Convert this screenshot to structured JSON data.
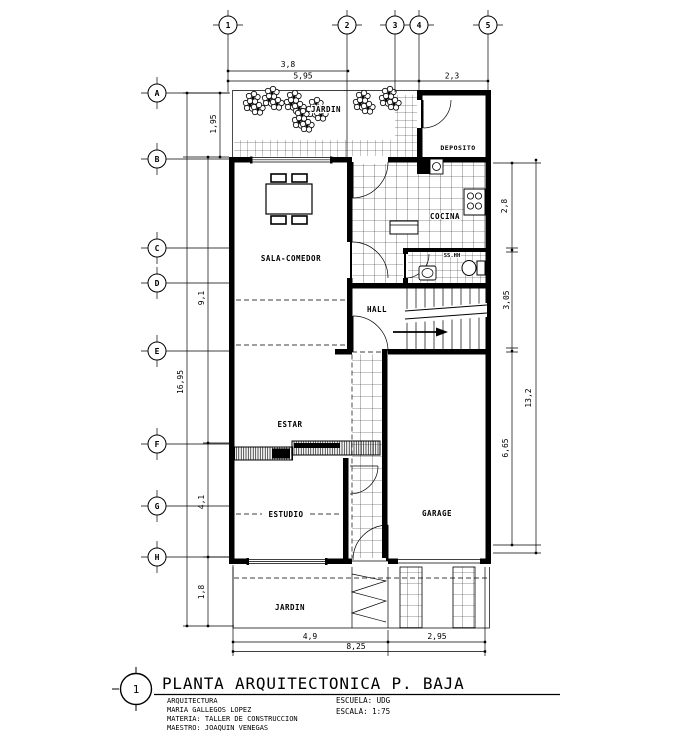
{
  "drawing": {
    "number": "1",
    "title": "PLANTA ARQUITECTONICA P. BAJA",
    "credits": {
      "line1": "ARQUITECTURA",
      "line2": "MARIA GALLEGOS LOPEZ",
      "line3": "MATERIA: TALLER DE CONSTRUCCION",
      "line4": "MAESTRO: JOAQUIN VENEGAS"
    },
    "school": "ESCUELA: UDG",
    "scale": "ESCALA: 1:75"
  },
  "rooms": {
    "jardin_top": "JARDIN",
    "deposito": "DEPOSITO",
    "sala_comedor": "SALA-COMEDOR",
    "cocina": "COCINA",
    "bano": "SS.HH",
    "hall": "HALL",
    "estar": "ESTAR",
    "estudio": "ESTUDIO",
    "garage": "GARAGE",
    "jardin_bottom": "JARDIN"
  },
  "grid": {
    "cols": {
      "c1": "1",
      "c2": "2",
      "c3": "3",
      "c4": "4",
      "c5": "5"
    },
    "rows": {
      "rA": "A",
      "rB": "B",
      "rC": "C",
      "rD": "D",
      "rE": "E",
      "rF": "F",
      "rG": "G",
      "rH": "H"
    }
  },
  "dims": {
    "top_38": "3,8",
    "top_595": "5,95",
    "top_23": "2,3",
    "left_195": "1,95",
    "left_1695": "16,95",
    "left_91": "9,1",
    "left_41": "4,1",
    "left_18": "1,8",
    "right_28": "2,8",
    "right_305": "3,05",
    "right_665": "6,65",
    "right_132": "13,2",
    "bottom_49": "4,9",
    "bottom_295": "2,95",
    "bottom_825": "8,25"
  }
}
